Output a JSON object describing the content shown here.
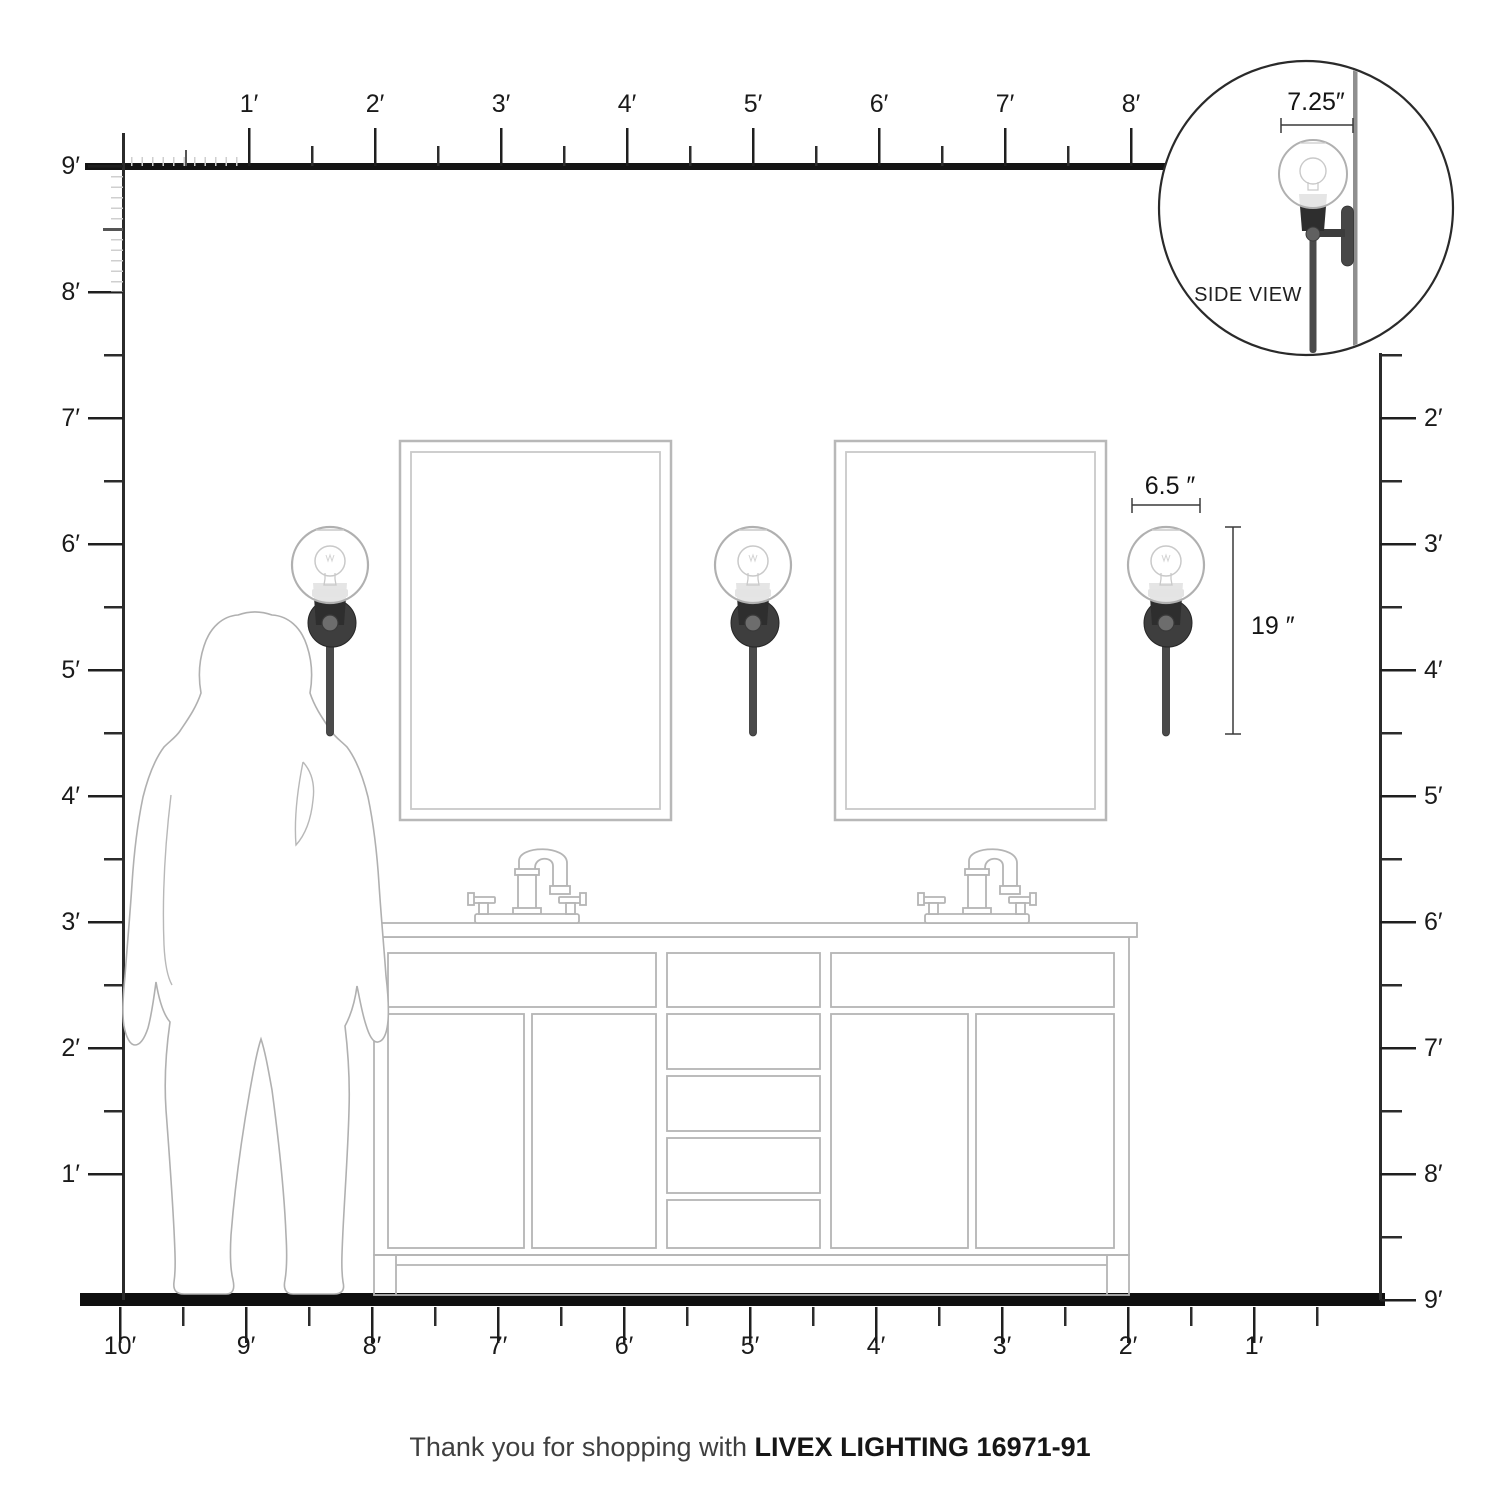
{
  "rulers": {
    "top": {
      "labels": [
        "1′",
        "2′",
        "3′",
        "4′",
        "5′",
        "6′",
        "7′",
        "8′"
      ]
    },
    "left": {
      "labels": [
        "9′",
        "8′",
        "7′",
        "6′",
        "5′",
        "4′",
        "3′",
        "2′",
        "1′"
      ]
    },
    "right": {
      "labels": [
        "2′",
        "3′",
        "4′",
        "5′",
        "6′",
        "7′",
        "8′",
        "9′"
      ]
    },
    "bottom": {
      "labels": [
        "10′",
        "9′",
        "8′",
        "7′",
        "6′",
        "5′",
        "4′",
        "3′",
        "2′",
        "1′"
      ]
    }
  },
  "inset": {
    "dimension_label": "7.25″",
    "caption": "SIDE VIEW"
  },
  "sconce_dimensions": {
    "width_label": "6.5 ″",
    "height_label": "19 ″"
  },
  "footer": {
    "message": "Thank you for shopping with",
    "product": "LIVEX LIGHTING 16971-91"
  },
  "colors": {
    "ruler_line": "#1a1a1a",
    "fixture_outline": "#b5b5b5",
    "metal_dark": "#3a3a3a",
    "silhouette_outline": "#b0b0b0"
  }
}
